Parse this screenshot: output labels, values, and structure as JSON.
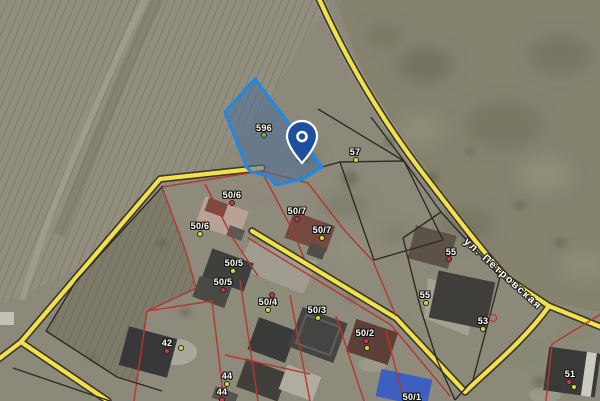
{
  "map": {
    "view": "satellite-cadastral",
    "selected_parcel": {
      "number": "596",
      "fill_color": "#4d7096",
      "border_color": "#1e88e8",
      "pin": {
        "x": 302,
        "y": 160
      }
    },
    "street_label": {
      "text": "ул. Петровская",
      "angle_deg": 42
    },
    "colors": {
      "road_fill": "#f3e14c",
      "road_casing": "#3b392e",
      "parcel_line_red": "#b5372e",
      "parcel_line_black": "#2d2c24",
      "label_text": "#ffffff",
      "dot_red": "#d62e54",
      "dot_yellow": "#cddc39",
      "dot_green": "#7cb342",
      "pin_blue": "#1d4f9e"
    },
    "parcel_labels": [
      {
        "text": "596",
        "x": 264,
        "y": 128,
        "dots": [
          {
            "color": "green",
            "x": 264,
            "y": 135
          }
        ]
      },
      {
        "text": "57",
        "x": 355,
        "y": 152,
        "dots": [
          {
            "color": "yellow",
            "x": 356,
            "y": 160
          }
        ]
      },
      {
        "text": "50/6",
        "x": 232,
        "y": 195,
        "dots": [
          {
            "color": "red",
            "x": 232,
            "y": 203
          }
        ]
      },
      {
        "text": "50/6",
        "x": 200,
        "y": 226,
        "dots": [
          {
            "color": "yellow",
            "x": 200,
            "y": 234
          }
        ]
      },
      {
        "text": "50/7",
        "x": 297,
        "y": 211,
        "dots": [
          {
            "color": "red",
            "x": 297,
            "y": 219
          }
        ]
      },
      {
        "text": "50/7",
        "x": 322,
        "y": 230,
        "dots": [
          {
            "color": "yellow",
            "x": 322,
            "y": 238
          }
        ]
      },
      {
        "text": "50/5",
        "x": 234,
        "y": 263,
        "dots": [
          {
            "color": "yellow",
            "x": 233,
            "y": 271
          }
        ]
      },
      {
        "text": "50/5",
        "x": 223,
        "y": 282,
        "dots": [
          {
            "color": "red",
            "x": 223,
            "y": 290
          }
        ]
      },
      {
        "text": "50/4",
        "x": 268,
        "y": 302,
        "dots": [
          {
            "color": "red",
            "x": 272,
            "y": 295
          },
          {
            "color": "yellow",
            "x": 268,
            "y": 310
          }
        ]
      },
      {
        "text": "50/3",
        "x": 317,
        "y": 310,
        "dots": [
          {
            "color": "yellow",
            "x": 318,
            "y": 318
          }
        ]
      },
      {
        "text": "50/2",
        "x": 365,
        "y": 333,
        "dots": [
          {
            "color": "red",
            "x": 366,
            "y": 341
          },
          {
            "color": "yellow",
            "x": 367,
            "y": 348
          }
        ]
      },
      {
        "text": "42",
        "x": 167,
        "y": 343,
        "dots": [
          {
            "color": "red",
            "x": 167,
            "y": 351
          },
          {
            "color": "yellow",
            "x": 181,
            "y": 348
          }
        ]
      },
      {
        "text": "44",
        "x": 227,
        "y": 376,
        "dots": [
          {
            "color": "yellow",
            "x": 227,
            "y": 384
          }
        ]
      },
      {
        "text": "44",
        "x": 222,
        "y": 392,
        "dots": [
          {
            "color": "red",
            "x": 222,
            "y": 400
          }
        ]
      },
      {
        "text": "55",
        "x": 451,
        "y": 252,
        "dots": [
          {
            "color": "red",
            "x": 449,
            "y": 259
          }
        ]
      },
      {
        "text": "55",
        "x": 425,
        "y": 295,
        "dots": [
          {
            "color": "yellow",
            "x": 426,
            "y": 303
          }
        ]
      },
      {
        "text": "53",
        "x": 483,
        "y": 321,
        "dots": [
          {
            "color": "yellow",
            "x": 483,
            "y": 329
          },
          {
            "color": "red-ring",
            "x": 493,
            "y": 318
          }
        ]
      },
      {
        "text": "51",
        "x": 570,
        "y": 374,
        "dots": [
          {
            "color": "red",
            "x": 569,
            "y": 382
          },
          {
            "color": "yellow",
            "x": 574,
            "y": 387
          }
        ]
      },
      {
        "text": "50/1",
        "x": 412,
        "y": 397,
        "dots": []
      }
    ]
  }
}
